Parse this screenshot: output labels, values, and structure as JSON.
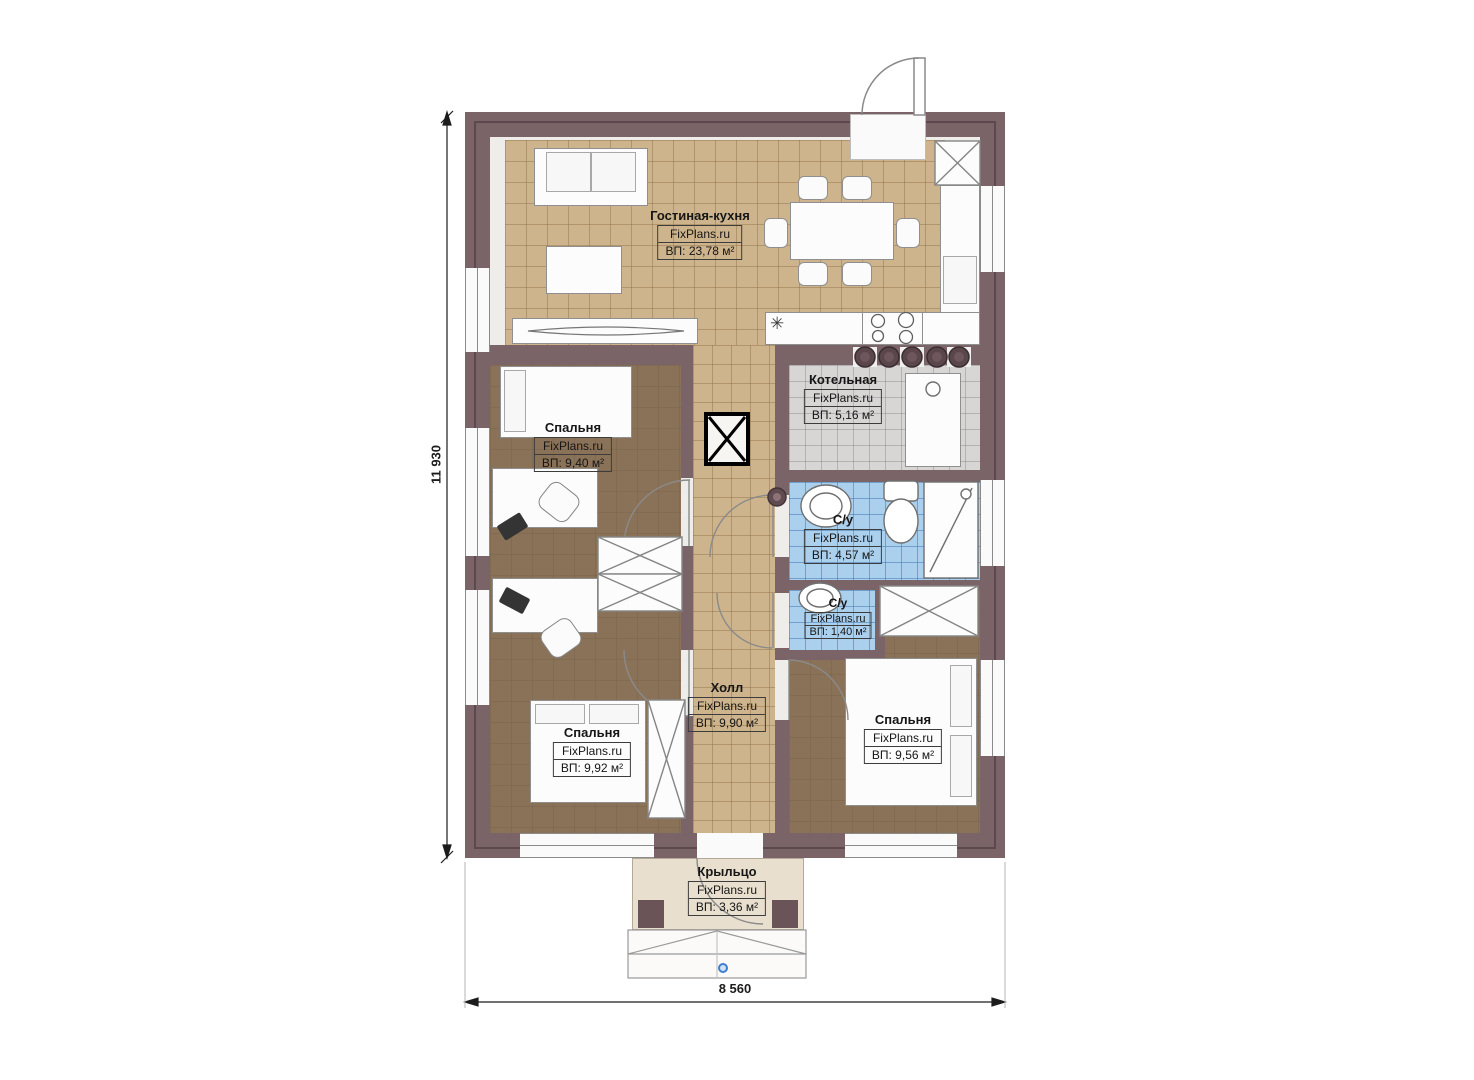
{
  "plan": {
    "brand": "FixPlans.ru",
    "rooms": {
      "living": {
        "name": "Гостиная-кухня",
        "brand": "FixPlans.ru",
        "area": "ВП: 23,78 м²"
      },
      "boiler": {
        "name": "Котельная",
        "brand": "FixPlans.ru",
        "area": "ВП: 5,16 м²"
      },
      "bedroom1": {
        "name": "Спальня",
        "brand": "FixPlans.ru",
        "area": "ВП: 9,40 м²"
      },
      "bath1": {
        "name": "С/у",
        "brand": "FixPlans.ru",
        "area": "ВП: 4,57 м²"
      },
      "bath2": {
        "name": "С/у",
        "brand": "FixPlans.ru",
        "area": "ВП: 1,40 м²"
      },
      "hall": {
        "name": "Холл",
        "brand": "FixPlans.ru",
        "area": "ВП: 9,90 м²"
      },
      "bedroom2": {
        "name": "Спальня",
        "brand": "FixPlans.ru",
        "area": "ВП: 9,92 м²"
      },
      "bedroom3": {
        "name": "Спальня",
        "brand": "FixPlans.ru",
        "area": "ВП: 9,56 м²"
      },
      "porch": {
        "name": "Крыльцо",
        "brand": "FixPlans.ru",
        "area": "ВП: 3,36 м²"
      }
    },
    "dimensions": {
      "height": "11 930",
      "width": "8 560"
    },
    "icons": {
      "light": "✳"
    },
    "colors": {
      "wall": "#7b6467",
      "tile_tan": "#cdb48c",
      "floor_brown": "#8a7258",
      "bath_blue": "#abd0ee",
      "boiler_gray": "#d8d6d5",
      "porch_beige": "#e9dfcf"
    }
  }
}
